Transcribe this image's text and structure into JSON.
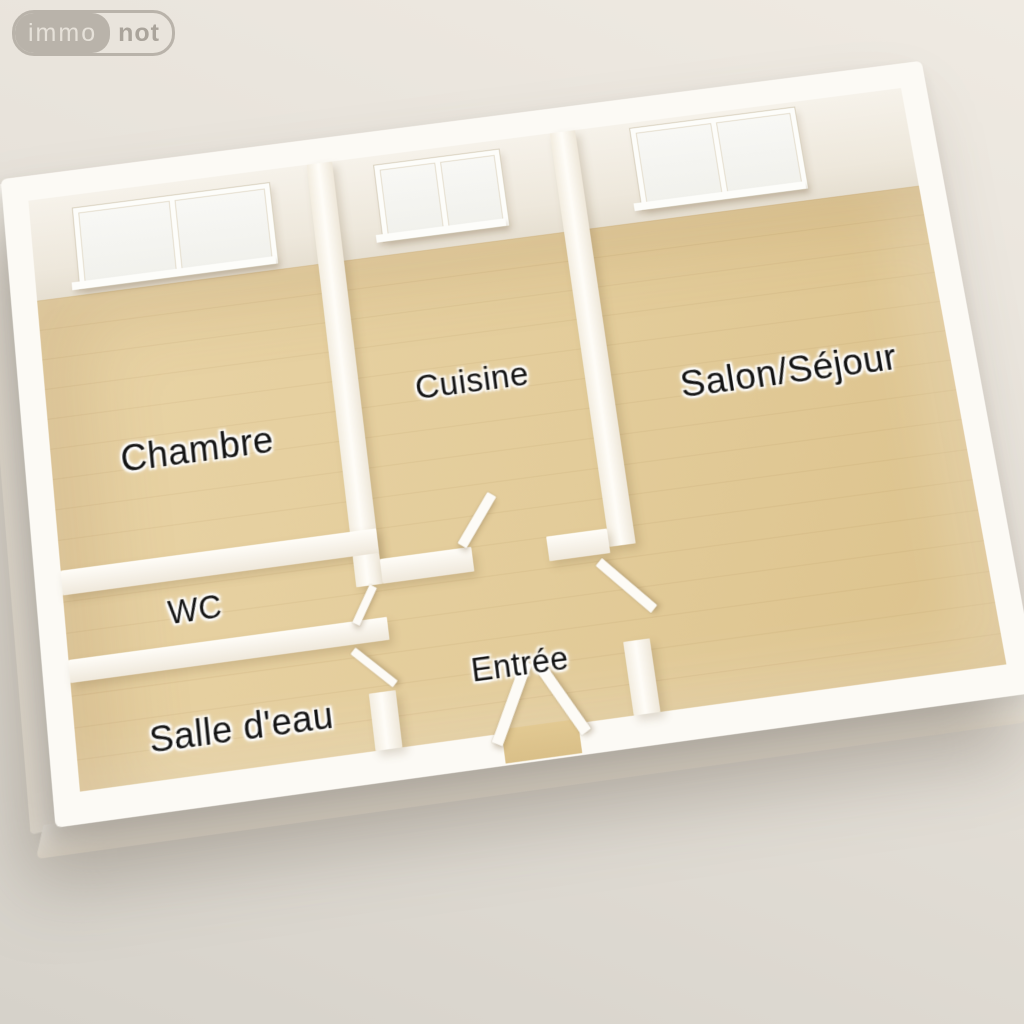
{
  "logo": {
    "immo": "immo",
    "not": "not"
  },
  "floorplan": {
    "type": "3d-floor-plan",
    "rooms": [
      {
        "id": "chambre",
        "label": "Chambre"
      },
      {
        "id": "cuisine",
        "label": "Cuisine"
      },
      {
        "id": "salon",
        "label": "Salon/Séjour"
      },
      {
        "id": "wc",
        "label": "WC"
      },
      {
        "id": "entree",
        "label": "Entrée"
      },
      {
        "id": "salle-deau",
        "label": "Salle d'eau"
      }
    ],
    "windows": [
      {
        "room": "chambre",
        "panes": 2
      },
      {
        "room": "cuisine",
        "panes": 2
      },
      {
        "room": "salon",
        "panes": 2
      }
    ],
    "doors": [
      "entrance",
      "cuisine",
      "salon",
      "wc",
      "salle-deau"
    ]
  },
  "colors": {
    "background_top": "#efeae2",
    "background_bottom": "#d6d2ca",
    "wall_white": "#fcfaf5",
    "wall_inner_face": "#eee8dc",
    "floor_wood": "#e3cc9a",
    "floor_plank_line": "#c9ad78",
    "label_text": "#131313",
    "label_halo": "#ffffff",
    "logo_gray": "#b9b3aa"
  }
}
